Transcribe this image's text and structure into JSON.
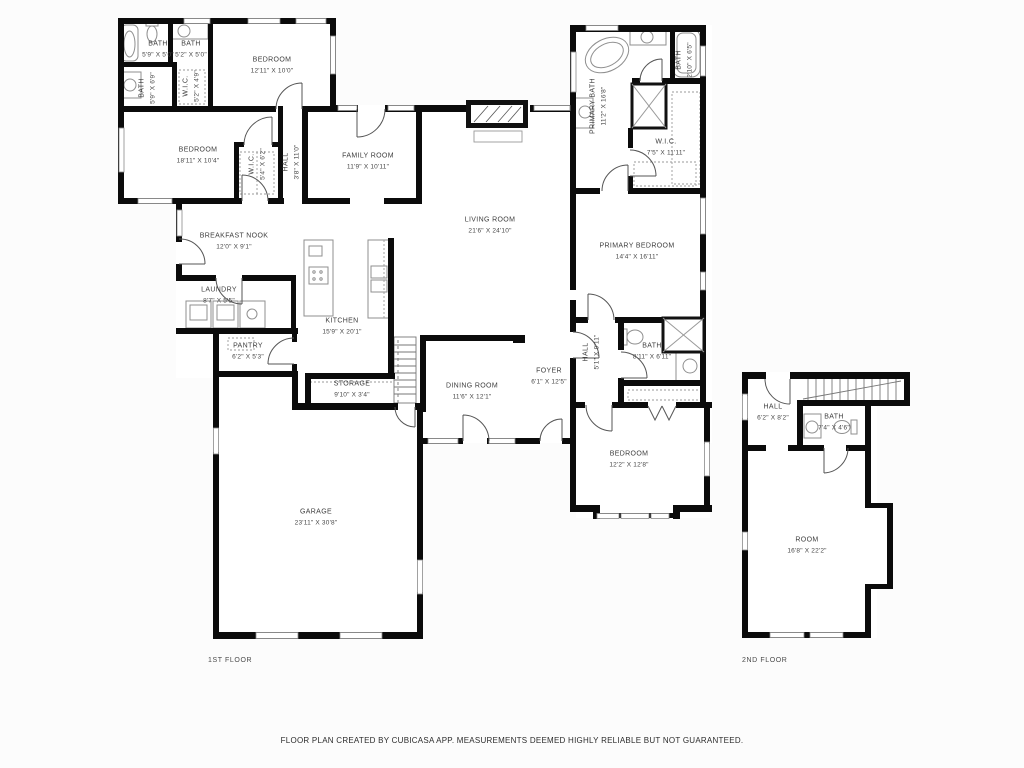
{
  "page": {
    "background": "#fcfcfc",
    "footer_note": "FLOOR PLAN CREATED BY CUBICASA APP. MEASUREMENTS DEEMED HIGHLY RELIABLE BUT NOT GUARANTEED."
  },
  "colors": {
    "wall": "#0b0b0b",
    "room_fill": "#ffffff",
    "fixture_stroke": "#8f8f8f",
    "door_line": "#555555",
    "label_text": "#3e3e3e"
  },
  "floor1": {
    "label": "1ST FLOOR",
    "rooms": [
      {
        "name": "BATH",
        "dims": "5'9\" X 5'0\""
      },
      {
        "name": "BATH",
        "dims": "5'2\" X 5'0\""
      },
      {
        "name": "BEDROOM",
        "dims": "12'11\" X 10'0\""
      },
      {
        "name": "BATH",
        "dims": "5'9\" X 6'9\""
      },
      {
        "name": "W.I.C.",
        "dims": "5'2\" X 4'9\""
      },
      {
        "name": "BEDROOM",
        "dims": "18'11\" X 10'4\""
      },
      {
        "name": "W.I.C.",
        "dims": "5'4\" X 6'2\""
      },
      {
        "name": "HALL",
        "dims": "3'8\" X 11'0\""
      },
      {
        "name": "FAMILY ROOM",
        "dims": "11'9\" X 10'11\""
      },
      {
        "name": "LIVING ROOM",
        "dims": "21'6\" X 24'10\""
      },
      {
        "name": "PRIMARY BATH",
        "dims": "11'2\" X 16'8\""
      },
      {
        "name": "BATH",
        "dims": "2'10\" X 6'5\""
      },
      {
        "name": "W.I.C.",
        "dims": "7'5\" X 11'11\""
      },
      {
        "name": "PRIMARY BEDROOM",
        "dims": "14'4\" X 16'11\""
      },
      {
        "name": "BREAKFAST NOOK",
        "dims": "12'0\" X 9'1\""
      },
      {
        "name": "LAUNDRY",
        "dims": "8'7\" X 5'5\""
      },
      {
        "name": "PANTRY",
        "dims": "6'2\" X 5'3\""
      },
      {
        "name": "KITCHEN",
        "dims": "15'9\" X 20'1\""
      },
      {
        "name": "STORAGE",
        "dims": "9'10\" X 3'4\""
      },
      {
        "name": "DINING ROOM",
        "dims": "11'6\" X 12'1\""
      },
      {
        "name": "FOYER",
        "dims": "6'1\" X 12'5\""
      },
      {
        "name": "HALL",
        "dims": "5'1\" X 9'11\""
      },
      {
        "name": "BATH",
        "dims": "8'11\" X 6'11\""
      },
      {
        "name": "BEDROOM",
        "dims": "12'2\" X 12'8\""
      },
      {
        "name": "GARAGE",
        "dims": "23'11\" X 30'8\""
      }
    ]
  },
  "floor2": {
    "label": "2ND FLOOR",
    "rooms": [
      {
        "name": "HALL",
        "dims": "6'2\" X 8'2\""
      },
      {
        "name": "BATH",
        "dims": "7'4\" X 4'6\""
      },
      {
        "name": "ROOM",
        "dims": "16'8\" X 22'2\""
      }
    ]
  }
}
